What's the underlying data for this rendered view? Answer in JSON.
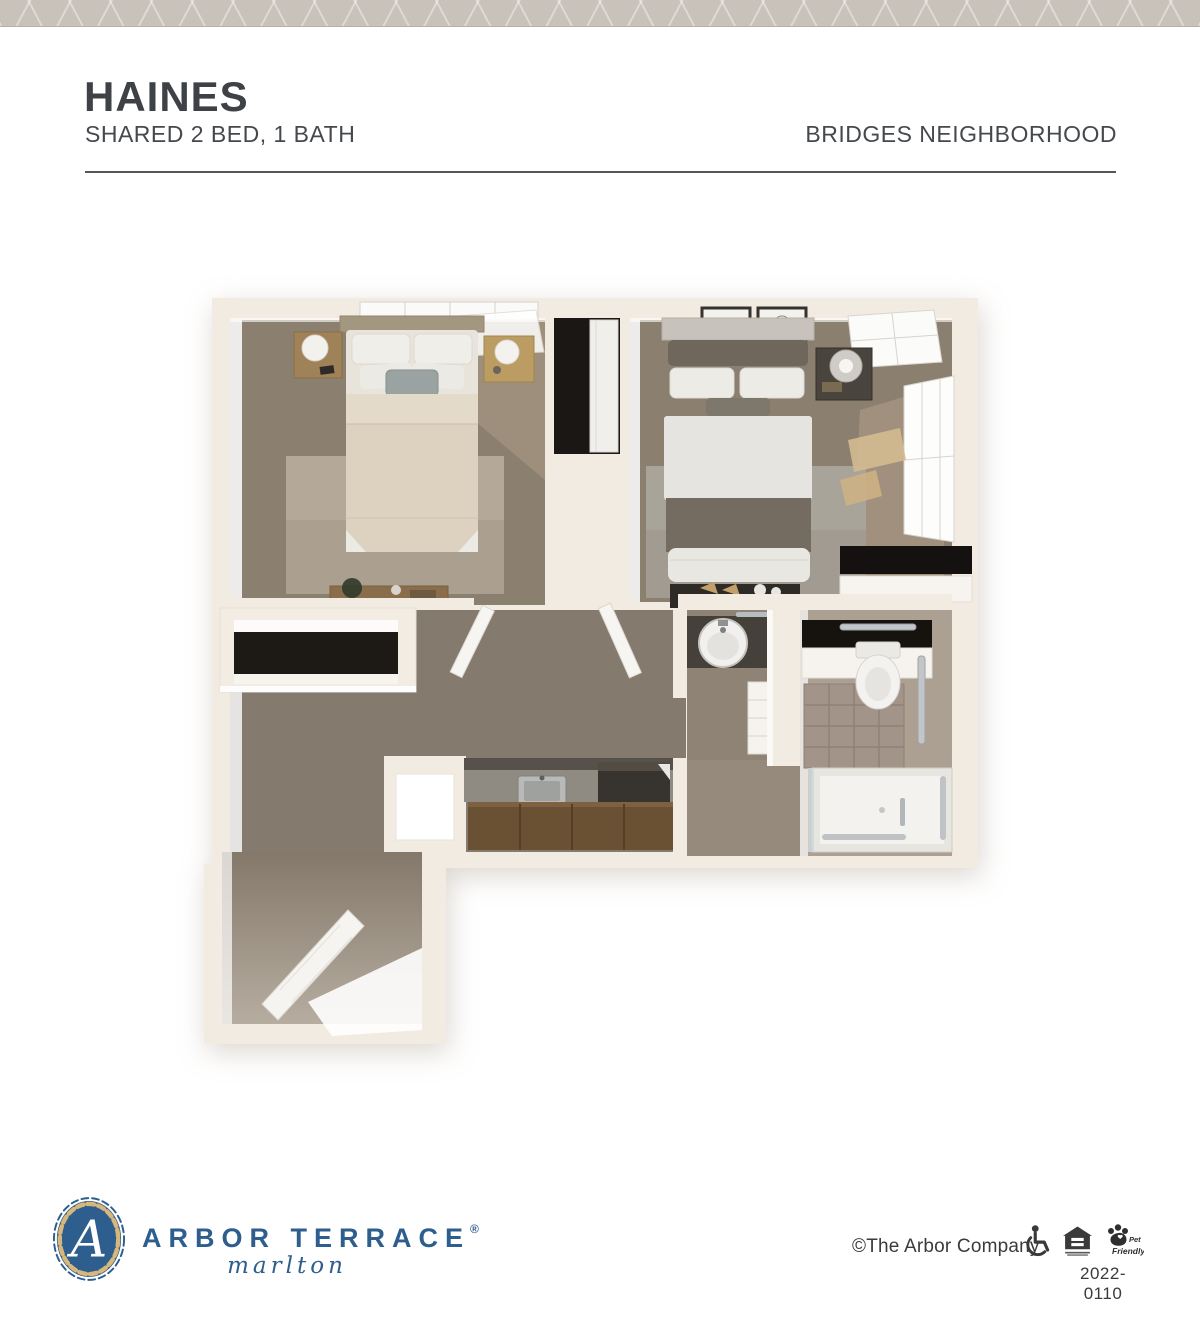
{
  "header": {
    "title": "HAINES",
    "subtitle": "SHARED 2 BED, 1 BATH",
    "neighborhood": "BRIDGES NEIGHBORHOOD"
  },
  "footer": {
    "logo": {
      "monogram": "A",
      "brand": "ARBOR TERRACE",
      "registered_mark": "®",
      "location": "marlton"
    },
    "copyright": "©The Arbor Company",
    "icons": [
      {
        "name": "wheelchair-accessible-icon"
      },
      {
        "name": "equal-housing-opportunity-icon"
      },
      {
        "name": "pet-friendly-icon",
        "label_top": "Pet",
        "label_bottom": "Friendly"
      }
    ],
    "document_number": "2022-0110"
  },
  "colors": {
    "brand_blue": "#2d5e8d",
    "badge_gold": "#d8b77c",
    "heading_text": "#3e4246",
    "top_band": "#c8c2ba",
    "plan_wall": "#f2ebe2",
    "plan_carpet": "#8b7f70",
    "plan_dark_interior": "#1b1714"
  }
}
